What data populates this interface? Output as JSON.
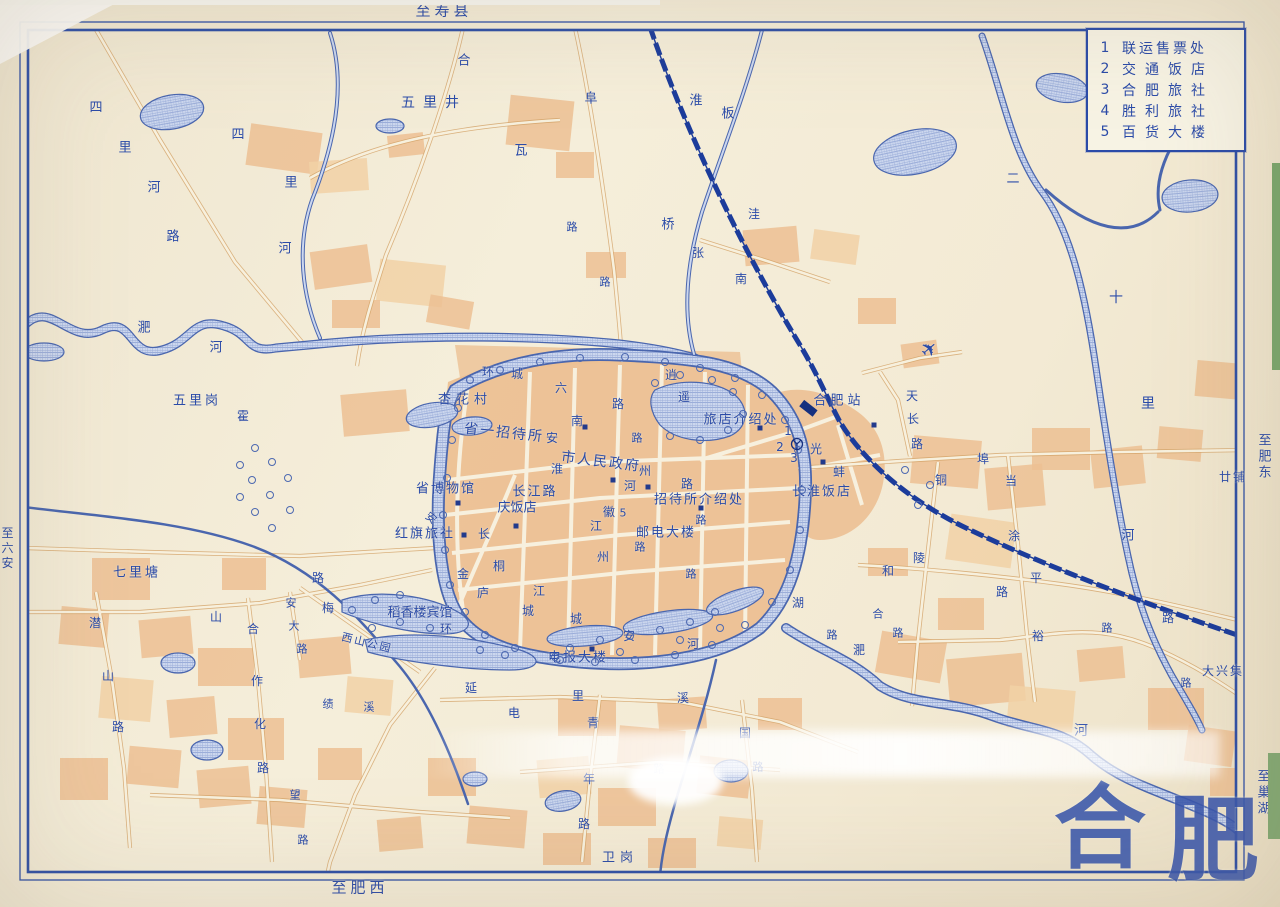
{
  "legend": {
    "items": [
      {
        "num": "1",
        "name": "联运售票处"
      },
      {
        "num": "2",
        "name": "交通饭店"
      },
      {
        "num": "3",
        "name": "合肥旅社"
      },
      {
        "num": "4",
        "name": "胜利旅社"
      },
      {
        "num": "5",
        "name": "百货大楼"
      }
    ]
  },
  "colors": {
    "ink": "#2b4ba8",
    "paper": "#f2e9d3",
    "urban": "#ecc093",
    "water": "#4a66ae",
    "rail": "#1c3c9b"
  },
  "labels": [
    {
      "t": "至寿县",
      "x": 444,
      "y": 11,
      "s": 15,
      "ls": 4
    },
    {
      "t": "至肥西",
      "x": 360,
      "y": 888,
      "s": 15,
      "ls": 4
    },
    {
      "t": "至肥东",
      "x": 1263,
      "y": 457,
      "s": 13,
      "v": 1
    },
    {
      "t": "至巢湖",
      "x": 1262,
      "y": 793,
      "s": 13,
      "v": 1
    },
    {
      "t": "至六安",
      "x": 7,
      "y": 549,
      "s": 12,
      "v": 1
    },
    {
      "t": "五里井",
      "x": 434,
      "y": 103,
      "s": 14,
      "ls": 8
    },
    {
      "t": "合",
      "x": 464,
      "y": 61,
      "s": 13
    },
    {
      "t": "阜",
      "x": 591,
      "y": 99,
      "s": 13
    },
    {
      "t": "瓦",
      "x": 521,
      "y": 151,
      "s": 13
    },
    {
      "t": "淮",
      "x": 696,
      "y": 101,
      "s": 13
    },
    {
      "t": "板",
      "x": 728,
      "y": 114,
      "s": 13
    },
    {
      "t": "桥",
      "x": 668,
      "y": 225,
      "s": 13
    },
    {
      "t": "张",
      "x": 698,
      "y": 253,
      "s": 12
    },
    {
      "t": "洼",
      "x": 754,
      "y": 214,
      "s": 12
    },
    {
      "t": "路",
      "x": 572,
      "y": 227,
      "s": 11
    },
    {
      "t": "路",
      "x": 605,
      "y": 282,
      "s": 11
    },
    {
      "t": "二",
      "x": 1013,
      "y": 179,
      "s": 13
    },
    {
      "t": "十",
      "x": 1116,
      "y": 298,
      "s": 14
    },
    {
      "t": "里",
      "x": 1148,
      "y": 404,
      "s": 14
    },
    {
      "t": "河",
      "x": 1128,
      "y": 536,
      "s": 13
    },
    {
      "t": "廿铺",
      "x": 1233,
      "y": 477,
      "s": 12,
      "ls": 2
    },
    {
      "t": "四",
      "x": 96,
      "y": 108,
      "s": 13
    },
    {
      "t": "里",
      "x": 125,
      "y": 148,
      "s": 13
    },
    {
      "t": "河",
      "x": 154,
      "y": 188,
      "s": 13
    },
    {
      "t": "路",
      "x": 173,
      "y": 237,
      "s": 13
    },
    {
      "t": "四",
      "x": 238,
      "y": 135,
      "s": 13
    },
    {
      "t": "里",
      "x": 291,
      "y": 183,
      "s": 13
    },
    {
      "t": "河",
      "x": 285,
      "y": 249,
      "s": 13
    },
    {
      "t": "淝",
      "x": 144,
      "y": 328,
      "s": 13
    },
    {
      "t": "河",
      "x": 216,
      "y": 348,
      "s": 13
    },
    {
      "t": "五里岗",
      "x": 197,
      "y": 401,
      "s": 13,
      "ls": 3
    },
    {
      "t": "霍",
      "x": 243,
      "y": 416,
      "s": 12
    },
    {
      "t": "七里塘",
      "x": 137,
      "y": 573,
      "s": 13,
      "ls": 3
    },
    {
      "t": "潜",
      "x": 95,
      "y": 623,
      "s": 12
    },
    {
      "t": "山",
      "x": 108,
      "y": 676,
      "s": 12
    },
    {
      "t": "路",
      "x": 118,
      "y": 727,
      "s": 12
    },
    {
      "t": "山",
      "x": 216,
      "y": 617,
      "s": 12
    },
    {
      "t": "路",
      "x": 318,
      "y": 578,
      "s": 12
    },
    {
      "t": "合",
      "x": 253,
      "y": 629,
      "s": 12
    },
    {
      "t": "作",
      "x": 257,
      "y": 681,
      "s": 12
    },
    {
      "t": "化",
      "x": 260,
      "y": 724,
      "s": 12
    },
    {
      "t": "路",
      "x": 263,
      "y": 768,
      "s": 12
    },
    {
      "t": "安",
      "x": 291,
      "y": 603,
      "s": 11
    },
    {
      "t": "大",
      "x": 294,
      "y": 626,
      "s": 11
    },
    {
      "t": "路",
      "x": 302,
      "y": 649,
      "s": 11
    },
    {
      "t": "梅",
      "x": 328,
      "y": 608,
      "s": 12
    },
    {
      "t": "西山公园",
      "x": 367,
      "y": 643,
      "s": 11,
      "r": 14,
      "ls": 2
    },
    {
      "t": "绩",
      "x": 328,
      "y": 704,
      "s": 11
    },
    {
      "t": "溪",
      "x": 369,
      "y": 707,
      "s": 11
    },
    {
      "t": "望",
      "x": 295,
      "y": 795,
      "s": 11
    },
    {
      "t": "路",
      "x": 303,
      "y": 840,
      "s": 11
    },
    {
      "t": "杏花村",
      "x": 465,
      "y": 400,
      "s": 13,
      "ls": 5
    },
    {
      "t": "省一招待所",
      "x": 504,
      "y": 433,
      "s": 14,
      "r": 6,
      "ls": 2
    },
    {
      "t": "环",
      "x": 488,
      "y": 372,
      "s": 12
    },
    {
      "t": "城",
      "x": 517,
      "y": 374,
      "s": 12
    },
    {
      "t": "六",
      "x": 561,
      "y": 388,
      "s": 12
    },
    {
      "t": "南",
      "x": 577,
      "y": 421,
      "s": 12
    },
    {
      "t": "安",
      "x": 552,
      "y": 438,
      "s": 12
    },
    {
      "t": "路",
      "x": 618,
      "y": 404,
      "s": 12
    },
    {
      "t": "逍",
      "x": 671,
      "y": 375,
      "s": 12
    },
    {
      "t": "遥",
      "x": 684,
      "y": 397,
      "s": 12
    },
    {
      "t": "市人民政府",
      "x": 601,
      "y": 462,
      "s": 14,
      "r": 7,
      "ls": 2
    },
    {
      "t": "淮",
      "x": 557,
      "y": 469,
      "s": 12
    },
    {
      "t": "河",
      "x": 630,
      "y": 486,
      "s": 12
    },
    {
      "t": "路",
      "x": 687,
      "y": 484,
      "s": 12
    },
    {
      "t": "州",
      "x": 645,
      "y": 471,
      "s": 12
    },
    {
      "t": "路",
      "x": 637,
      "y": 438,
      "s": 11
    },
    {
      "t": "南",
      "x": 741,
      "y": 279,
      "s": 12
    },
    {
      "t": "旅店介绍处",
      "x": 741,
      "y": 420,
      "s": 13,
      "ls": 2
    },
    {
      "t": "合肥站",
      "x": 839,
      "y": 401,
      "s": 13,
      "ls": 4
    },
    {
      "t": "天",
      "x": 912,
      "y": 396,
      "s": 12
    },
    {
      "t": "长",
      "x": 913,
      "y": 419,
      "s": 12
    },
    {
      "t": "路",
      "x": 917,
      "y": 444,
      "s": 12
    },
    {
      "t": "省博物馆",
      "x": 446,
      "y": 489,
      "s": 13,
      "ls": 2
    },
    {
      "t": "长江路",
      "x": 535,
      "y": 492,
      "s": 13,
      "ls": 2
    },
    {
      "t": "庆饭店",
      "x": 517,
      "y": 508,
      "s": 13
    },
    {
      "t": "红旗旅社",
      "x": 425,
      "y": 534,
      "s": 13,
      "ls": 2
    },
    {
      "t": "安",
      "x": 431,
      "y": 518,
      "s": 11,
      "r": 40
    },
    {
      "t": "长",
      "x": 484,
      "y": 534,
      "s": 12
    },
    {
      "t": "桐",
      "x": 499,
      "y": 566,
      "s": 12
    },
    {
      "t": "江",
      "x": 596,
      "y": 526,
      "s": 12
    },
    {
      "t": "徽",
      "x": 609,
      "y": 512,
      "s": 12
    },
    {
      "t": "5",
      "x": 623,
      "y": 513,
      "s": 11
    },
    {
      "t": "州",
      "x": 603,
      "y": 557,
      "s": 12
    },
    {
      "t": "路",
      "x": 640,
      "y": 547,
      "s": 11
    },
    {
      "t": "招待所介绍处",
      "x": 699,
      "y": 500,
      "s": 13,
      "ls": 2
    },
    {
      "t": "邮电大楼",
      "x": 666,
      "y": 533,
      "s": 13,
      "ls": 2
    },
    {
      "t": "路",
      "x": 701,
      "y": 520,
      "s": 11
    },
    {
      "t": "1",
      "x": 788,
      "y": 431,
      "s": 12
    },
    {
      "t": "2",
      "x": 780,
      "y": 447,
      "s": 12
    },
    {
      "t": "3",
      "x": 794,
      "y": 458,
      "s": 12
    },
    {
      "t": "光",
      "x": 816,
      "y": 449,
      "s": 12
    },
    {
      "t": "蚌",
      "x": 839,
      "y": 472,
      "s": 12
    },
    {
      "t": "长淮饭店",
      "x": 822,
      "y": 492,
      "s": 13,
      "ls": 2
    },
    {
      "t": "埠",
      "x": 983,
      "y": 459,
      "s": 12
    },
    {
      "t": "当",
      "x": 1011,
      "y": 481,
      "s": 12
    },
    {
      "t": "涂",
      "x": 1014,
      "y": 536,
      "s": 12
    },
    {
      "t": "铜",
      "x": 941,
      "y": 480,
      "s": 12
    },
    {
      "t": "陵",
      "x": 919,
      "y": 558,
      "s": 12
    },
    {
      "t": "路",
      "x": 1002,
      "y": 592,
      "s": 12
    },
    {
      "t": "和",
      "x": 888,
      "y": 571,
      "s": 12
    },
    {
      "t": "平",
      "x": 1036,
      "y": 578,
      "s": 12
    },
    {
      "t": "路",
      "x": 1168,
      "y": 618,
      "s": 12
    },
    {
      "t": "金",
      "x": 463,
      "y": 574,
      "s": 12
    },
    {
      "t": "庐",
      "x": 483,
      "y": 593,
      "s": 12
    },
    {
      "t": "稻香楼宾馆",
      "x": 420,
      "y": 613,
      "s": 13
    },
    {
      "t": "环",
      "x": 446,
      "y": 629,
      "s": 12
    },
    {
      "t": "江",
      "x": 539,
      "y": 591,
      "s": 12
    },
    {
      "t": "城",
      "x": 528,
      "y": 611,
      "s": 12
    },
    {
      "t": "城",
      "x": 576,
      "y": 619,
      "s": 12
    },
    {
      "t": "延",
      "x": 471,
      "y": 688,
      "s": 12
    },
    {
      "t": "安",
      "x": 629,
      "y": 636,
      "s": 12
    },
    {
      "t": "电报大楼",
      "x": 578,
      "y": 658,
      "s": 13,
      "ls": 2
    },
    {
      "t": "河",
      "x": 693,
      "y": 644,
      "s": 12
    },
    {
      "t": "湖",
      "x": 798,
      "y": 603,
      "s": 12
    },
    {
      "t": "路",
      "x": 832,
      "y": 635,
      "s": 11
    },
    {
      "t": "路",
      "x": 691,
      "y": 574,
      "s": 11
    },
    {
      "t": "合",
      "x": 878,
      "y": 614,
      "s": 11
    },
    {
      "t": "路",
      "x": 898,
      "y": 633,
      "s": 11
    },
    {
      "t": "淝",
      "x": 859,
      "y": 650,
      "s": 12
    },
    {
      "t": "河",
      "x": 1081,
      "y": 731,
      "s": 14
    },
    {
      "t": "裕",
      "x": 1038,
      "y": 636,
      "s": 12
    },
    {
      "t": "路",
      "x": 1107,
      "y": 628,
      "s": 11
    },
    {
      "t": "大兴集",
      "x": 1223,
      "y": 671,
      "s": 12,
      "ls": 2
    },
    {
      "t": "路",
      "x": 1186,
      "y": 683,
      "s": 11
    },
    {
      "t": "电",
      "x": 514,
      "y": 713,
      "s": 12
    },
    {
      "t": "里",
      "x": 578,
      "y": 696,
      "s": 12
    },
    {
      "t": "溪",
      "x": 683,
      "y": 698,
      "s": 12
    },
    {
      "t": "青",
      "x": 593,
      "y": 723,
      "s": 12
    },
    {
      "t": "年",
      "x": 589,
      "y": 779,
      "s": 12
    },
    {
      "t": "路",
      "x": 584,
      "y": 824,
      "s": 12
    },
    {
      "t": "国",
      "x": 745,
      "y": 733,
      "s": 12
    },
    {
      "t": "路",
      "x": 758,
      "y": 767,
      "s": 11
    },
    {
      "t": "路",
      "x": 659,
      "y": 769,
      "s": 11
    },
    {
      "t": "卫岗",
      "x": 620,
      "y": 858,
      "s": 13,
      "ls": 5
    },
    {
      "t": "✈",
      "x": 929,
      "y": 349,
      "s": 20,
      "r": -40
    },
    {
      "t": "合",
      "x": 1100,
      "y": 828,
      "s": 92,
      "c": "big"
    },
    {
      "t": "肥",
      "x": 1213,
      "y": 840,
      "s": 92,
      "c": "big"
    }
  ],
  "markers": {
    "dots": [
      [
        458,
        503
      ],
      [
        464,
        535
      ],
      [
        516,
        526
      ],
      [
        592,
        649
      ],
      [
        613,
        480
      ],
      [
        760,
        428
      ],
      [
        648,
        487
      ],
      [
        701,
        508
      ],
      [
        874,
        425
      ],
      [
        823,
        462
      ],
      [
        585,
        427
      ]
    ],
    "trees": [
      [
        470,
        380
      ],
      [
        500,
        370
      ],
      [
        540,
        362
      ],
      [
        580,
        358
      ],
      [
        625,
        357
      ],
      [
        665,
        362
      ],
      [
        700,
        368
      ],
      [
        735,
        378
      ],
      [
        762,
        395
      ],
      [
        785,
        420
      ],
      [
        798,
        450
      ],
      [
        802,
        490
      ],
      [
        800,
        530
      ],
      [
        790,
        570
      ],
      [
        772,
        602
      ],
      [
        745,
        625
      ],
      [
        712,
        645
      ],
      [
        675,
        655
      ],
      [
        635,
        660
      ],
      [
        595,
        662
      ],
      [
        555,
        657
      ],
      [
        515,
        648
      ],
      [
        485,
        635
      ],
      [
        465,
        612
      ],
      [
        450,
        585
      ],
      [
        445,
        550
      ],
      [
        443,
        515
      ],
      [
        447,
        478
      ],
      [
        452,
        440
      ],
      [
        458,
        408
      ],
      [
        255,
        448
      ],
      [
        272,
        462
      ],
      [
        252,
        480
      ],
      [
        270,
        495
      ],
      [
        255,
        512
      ],
      [
        272,
        528
      ],
      [
        288,
        478
      ],
      [
        290,
        510
      ],
      [
        240,
        465
      ],
      [
        240,
        497
      ],
      [
        655,
        383
      ],
      [
        680,
        375
      ],
      [
        712,
        380
      ],
      [
        733,
        392
      ],
      [
        743,
        414
      ],
      [
        728,
        430
      ],
      [
        700,
        440
      ],
      [
        670,
        436
      ],
      [
        570,
        648
      ],
      [
        600,
        640
      ],
      [
        630,
        636
      ],
      [
        660,
        630
      ],
      [
        690,
        622
      ],
      [
        715,
        612
      ],
      [
        560,
        660
      ],
      [
        620,
        652
      ],
      [
        680,
        640
      ],
      [
        720,
        628
      ],
      [
        352,
        610
      ],
      [
        375,
        600
      ],
      [
        400,
        595
      ],
      [
        372,
        628
      ],
      [
        400,
        622
      ],
      [
        430,
        628
      ],
      [
        480,
        650
      ],
      [
        505,
        655
      ],
      [
        905,
        470
      ],
      [
        930,
        485
      ],
      [
        918,
        505
      ]
    ]
  }
}
